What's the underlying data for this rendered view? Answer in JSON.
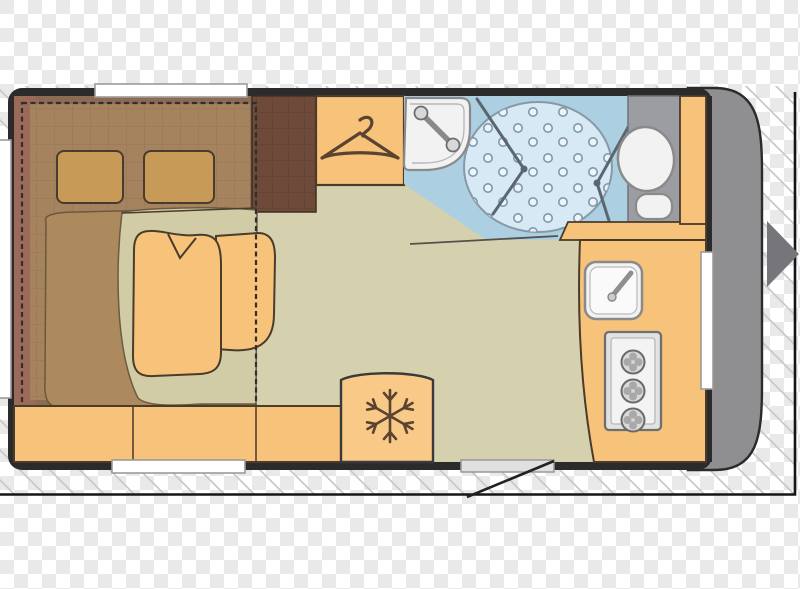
{
  "image": {
    "width": 800,
    "height": 589,
    "background": "transparency-checkerboard",
    "subject": "caravan floor plan"
  },
  "colors": {
    "checker_light": "#ffffff",
    "checker_dark": "#e9e9e9",
    "hatch_line": "#c9c9c9",
    "frame": "#151515",
    "wall": "#2b2b2b",
    "floor": "#d5d1ae",
    "furniture": "#f7c27a",
    "outline": "#4a3b2c",
    "bed_base": "#8d6b53",
    "bed_edge": "#9c6a58",
    "mattress": "#a5835f",
    "pillow": "#c89a58",
    "blanket": "#ad8a5e",
    "seat_pad": "#d2cca6",
    "cabinet": "#6e4a3a",
    "fridge": "#f9c987",
    "bath_floor": "#accfe2",
    "shower": "#d7e9f4",
    "shower_dot": "#7f99ab",
    "door_line": "#5b6770",
    "wc_floor": "#9c9ca3",
    "fixture": "#f2f2f2",
    "fixture_line": "#8a8a8a",
    "front": "#8f8f91",
    "arrow": "#75757a",
    "window": "#ffffff",
    "icon": "#5a4330"
  },
  "plan": {
    "areas": [
      {
        "name": "bedroom",
        "features": [
          "double-bed",
          "pillow-left",
          "pillow-right",
          "blanket",
          "armchair",
          "side-seat",
          "bench-seat",
          "bed-conversion-dashed-outline"
        ]
      },
      {
        "name": "wardrobe",
        "icon": "hanger-icon"
      },
      {
        "name": "cabinet",
        "features": [
          "tiled-top"
        ]
      },
      {
        "name": "bathroom",
        "features": [
          "washbasin",
          "shower-circle",
          "shower-folding-doors",
          "toilet"
        ]
      },
      {
        "name": "kitchen",
        "features": [
          "kitchen-sink",
          "stove"
        ],
        "stove_burners": 3
      },
      {
        "name": "fridge",
        "icon": "snowflake-icon"
      },
      {
        "name": "entrance",
        "features": [
          "door-sill",
          "door-swing-line",
          "entry-arrow"
        ]
      }
    ],
    "windows": [
      "window-top",
      "window-left",
      "window-bottom",
      "window-right"
    ]
  }
}
